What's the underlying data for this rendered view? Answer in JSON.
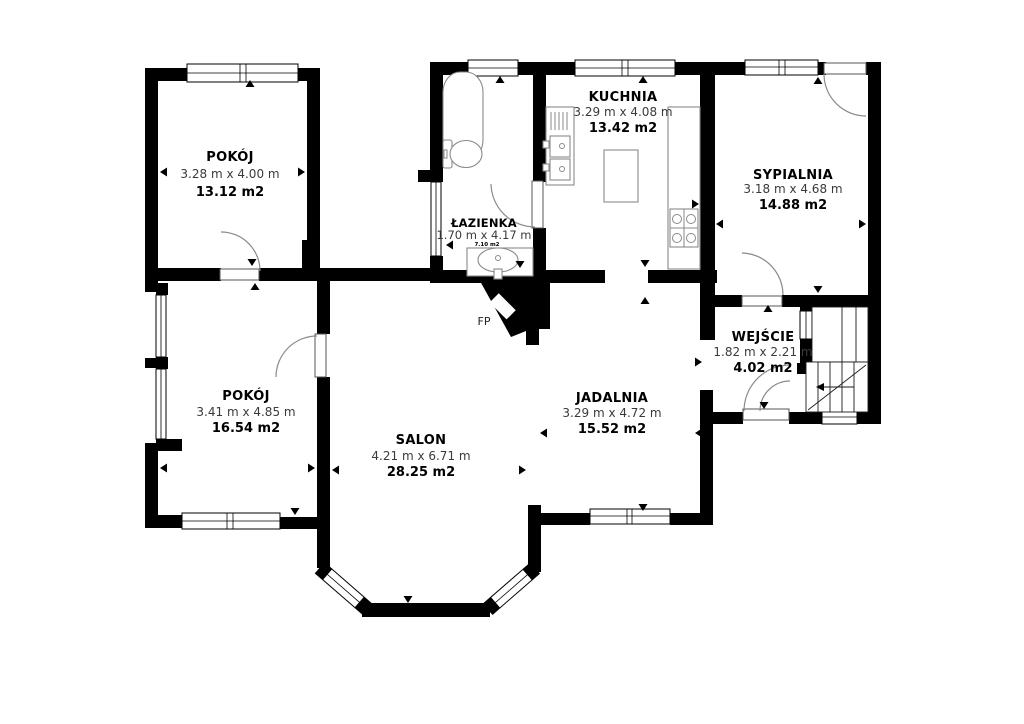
{
  "plan": {
    "background": "#ffffff",
    "wall_color": "#000000",
    "rooms": [
      {
        "name": "POKÓJ",
        "dims": "3.28 m x 4.00 m",
        "area": "13.12 m2"
      },
      {
        "name": "ŁAZIENKA",
        "dims": "1.70 m x 4.17 m",
        "area": "7.10 m2"
      },
      {
        "name": "KUCHNIA",
        "dims": "3.29 m x 4.08 m",
        "area": "13.42 m2"
      },
      {
        "name": "SYPIALNIA",
        "dims": "3.18 m x 4.68 m",
        "area": "14.88 m2"
      },
      {
        "name": "WEJŚCIE",
        "dims": "1.82 m x 2.21 m",
        "area": "4.02 m2"
      },
      {
        "name": "POKÓJ",
        "dims": "3.41 m x 4.85 m",
        "area": "16.54 m2"
      },
      {
        "name": "SALON",
        "dims": "4.21 m x 6.71 m",
        "area": "28.25 m2"
      },
      {
        "name": "JADALNIA",
        "dims": "3.29 m x 4.72 m",
        "area": "15.52 m2"
      }
    ],
    "fireplace_label": "FP"
  }
}
